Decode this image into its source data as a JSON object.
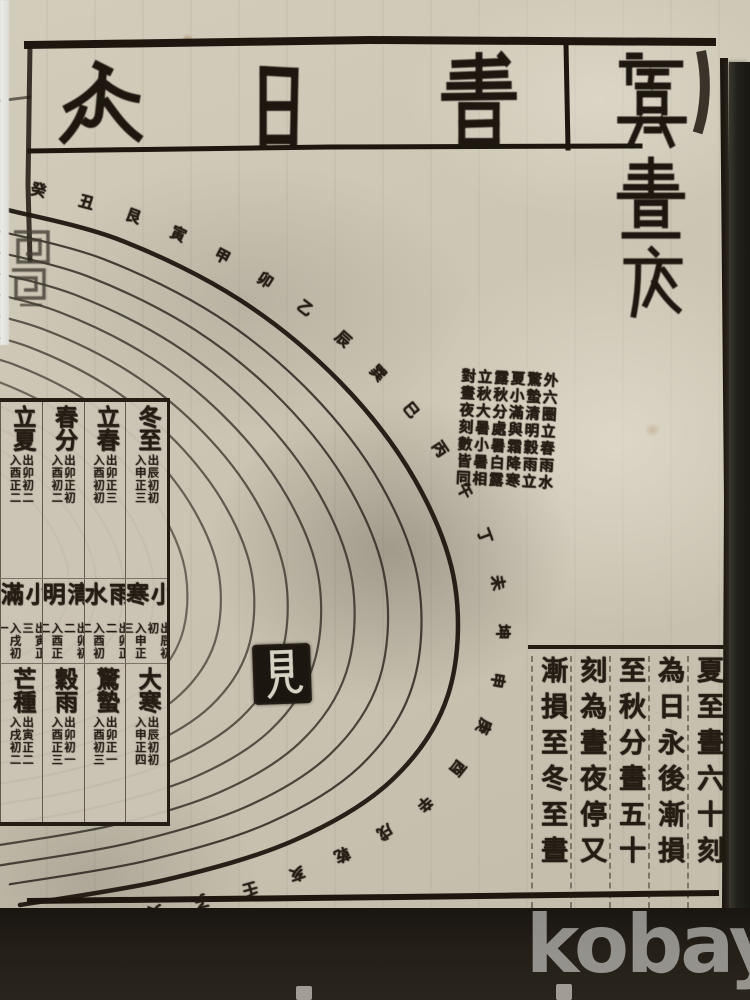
{
  "watermark": "kobay",
  "colors": {
    "paper": "#cbc4b2",
    "ink": "#241d14",
    "right_band": "#21211a",
    "bottom_band": "#241f17",
    "watermark_text": "rgba(252,251,247,0.52)"
  },
  "page": {
    "header": {
      "title_chars_rtl": [
        "書",
        "日",
        "永"
      ]
    },
    "margin_title": {
      "chars": [
        "虞",
        "晝",
        "夜"
      ]
    },
    "seal_char": "見",
    "solar_table": {
      "reading_order": "right-to-left",
      "rows": [
        {
          "cells": [
            {
              "term": "冬至",
              "sunrise": "出辰初初",
              "sunset": "入申正三"
            },
            {
              "term": "立春",
              "sunrise": "出卯正三",
              "sunset": "入酉初初"
            },
            {
              "term": "春分",
              "sunrise": "出卯正初",
              "sunset": "入酉初二"
            },
            {
              "term": "立夏",
              "sunrise": "出卯初二",
              "sunset": "入酉正二"
            }
          ]
        },
        {
          "cells": [
            {
              "term": "小寒",
              "sunrise": "出辰初初",
              "sunset": "入申正三"
            },
            {
              "term": "雨水",
              "sunrise": "出卯正二",
              "sunset": "入酉初二"
            },
            {
              "term": "清明",
              "sunrise": "出卯初二",
              "sunset": "入酉正二"
            },
            {
              "term": "小滿",
              "sunrise": "出寅正三",
              "sunset": "入戌初一"
            }
          ]
        },
        {
          "cells": [
            {
              "term": "大寒",
              "sunrise": "出辰初初",
              "sunset": "入申正四"
            },
            {
              "term": "驚蟄",
              "sunrise": "出卯正一",
              "sunset": "入酉初三"
            },
            {
              "term": "穀雨",
              "sunrise": "出卯初一",
              "sunset": "入酉正三"
            },
            {
              "term": "芒種",
              "sunrise": "出寅正二",
              "sunset": "入戌初二"
            }
          ]
        }
      ]
    },
    "annotation": {
      "columns_rtl": [
        "外六圈立春雨水",
        "驚蟄清明穀雨立",
        "夏小滿與霜降寒",
        "露秋分處暑白露",
        "立秋大暑小暑相",
        "對晝夜刻數皆同"
      ]
    },
    "day_length_text": {
      "columns_rtl": [
        "夏至晝六十刻",
        "為日永後漸損",
        "至秋分晝五十",
        "刻為晝夜停又",
        "漸損至冬至晝"
      ]
    },
    "rim_glyphs": [
      "癸",
      "丑",
      "艮",
      "寅",
      "甲",
      "卯",
      "乙",
      "辰",
      "巽",
      "巳",
      "丙",
      "午",
      "丁",
      "未",
      "坤",
      "申",
      "庚",
      "酉",
      "辛",
      "戌",
      "乾",
      "亥",
      "壬",
      "子",
      "癸",
      "丑",
      "艮"
    ]
  }
}
